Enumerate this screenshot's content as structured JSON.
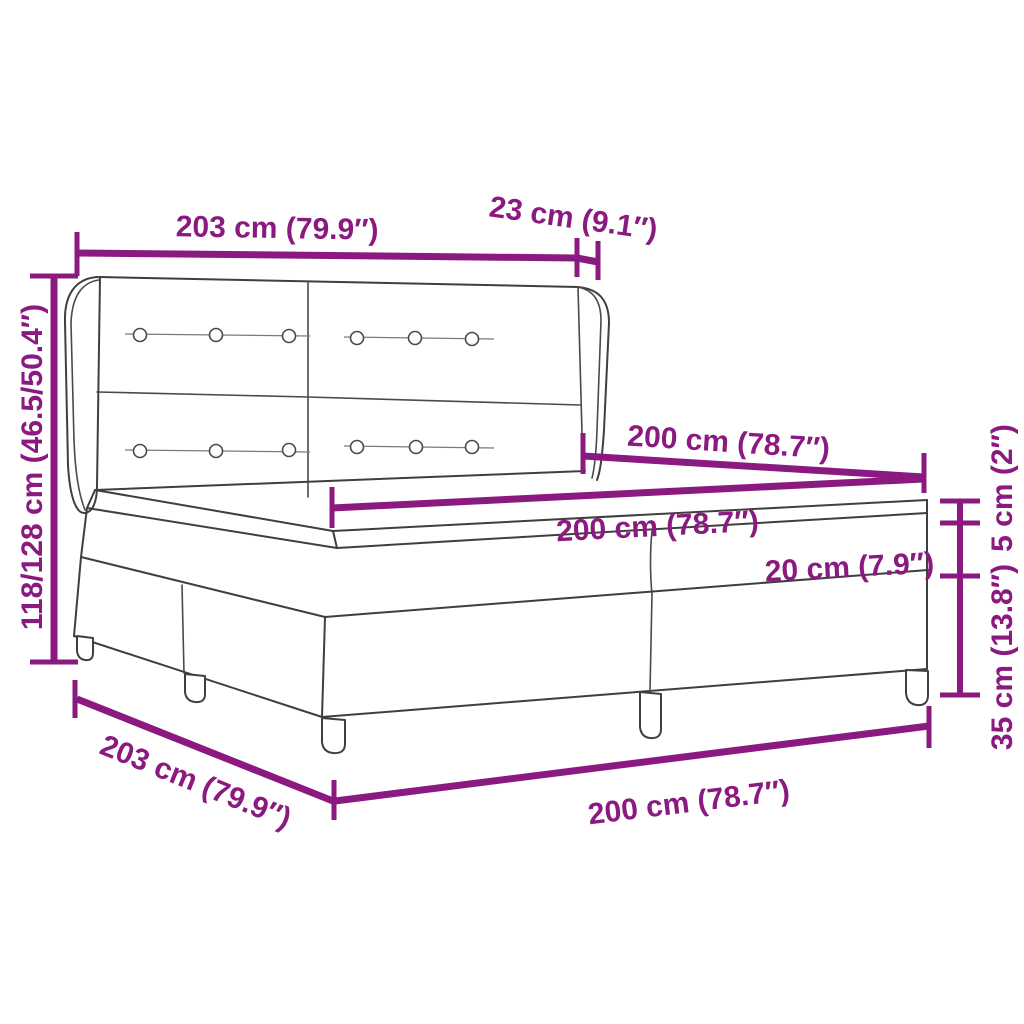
{
  "diagram": {
    "subject": "box-spring-bed-with-winged-headboard-dimension-diagram",
    "colors": {
      "dimension_accent": "#8B1A80",
      "drawing_outline": "#3F3F3F",
      "background": "#FFFFFF"
    },
    "labels": {
      "headboard_width": "203 cm (79.9″)",
      "headboard_side_depth": "23 cm (9.1″)",
      "total_height": "118/128 cm (46.5/50.4″)",
      "bed_length_top": "200 cm (78.7″)",
      "bed_width_inner": "200 cm (78.7″)",
      "mattress_height": "20 cm (7.9″)",
      "topper_height": "5 cm (2″)",
      "box_spring_height": "35 cm (13.8″)",
      "bed_depth_bottom": "203 cm (79.9″)",
      "bed_width_bottom": "200 cm (78.7″)"
    }
  }
}
